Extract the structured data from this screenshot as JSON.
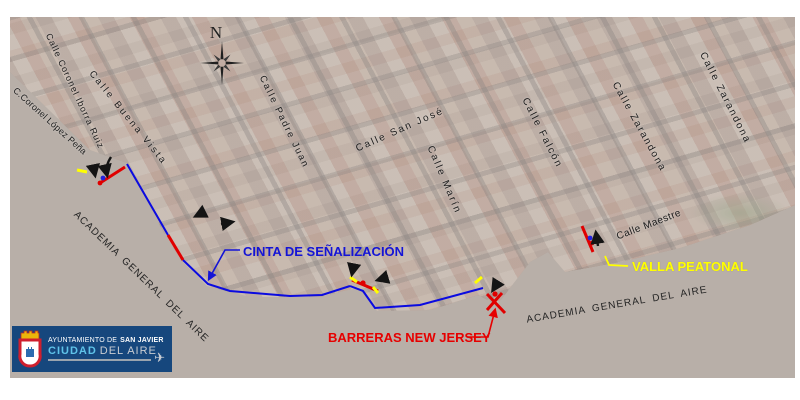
{
  "map": {
    "compass_label": "N",
    "streets": [
      {
        "label": "Calle Coronel Iborra Ruiz"
      },
      {
        "label": "C.Coronel López Peña"
      },
      {
        "label": "Calle Buena Vista"
      },
      {
        "label": "Calle Padre Juan"
      },
      {
        "label": "Calle San José"
      },
      {
        "label": "Calle Marín"
      },
      {
        "label": "Calle Falcón"
      },
      {
        "label": "Calle Zarandona"
      },
      {
        "label": "Calle Zarandona"
      },
      {
        "label": "Calle Maestre"
      }
    ],
    "area_labels": [
      "ACADEMIA GENERAL DEL AIRE",
      "ACADEMIA GENERAL DEL AIRE"
    ],
    "annotations": {
      "cinta": {
        "label": "CINTA DE SEÑALIZACIÓN",
        "color": "#1414d6"
      },
      "barreras": {
        "label": "BARRERAS NEW JERSEY",
        "color": "#e60000"
      },
      "valla": {
        "label": "VALLA PEATONAL",
        "color": "#ffff00"
      }
    },
    "legend": {
      "tape_line_color": "#0b0be0",
      "barrier_color": "#e00000",
      "fence_color": "#ffff00",
      "terrain_color": "#b8afa8"
    },
    "marker_icons": [
      "signal-tape-line",
      "new-jersey-barrier-marker",
      "pedestrian-fence-dash",
      "direction-arrow",
      "blue-point",
      "red-point",
      "compass-rose"
    ]
  },
  "logo": {
    "line1": "AYUNTAMIENTO DE",
    "line1_bold": "SAN JAVIER",
    "line2_primary": "CIUDAD",
    "line2_secondary": "DEL AIRE",
    "bg_color": "#16477d"
  }
}
